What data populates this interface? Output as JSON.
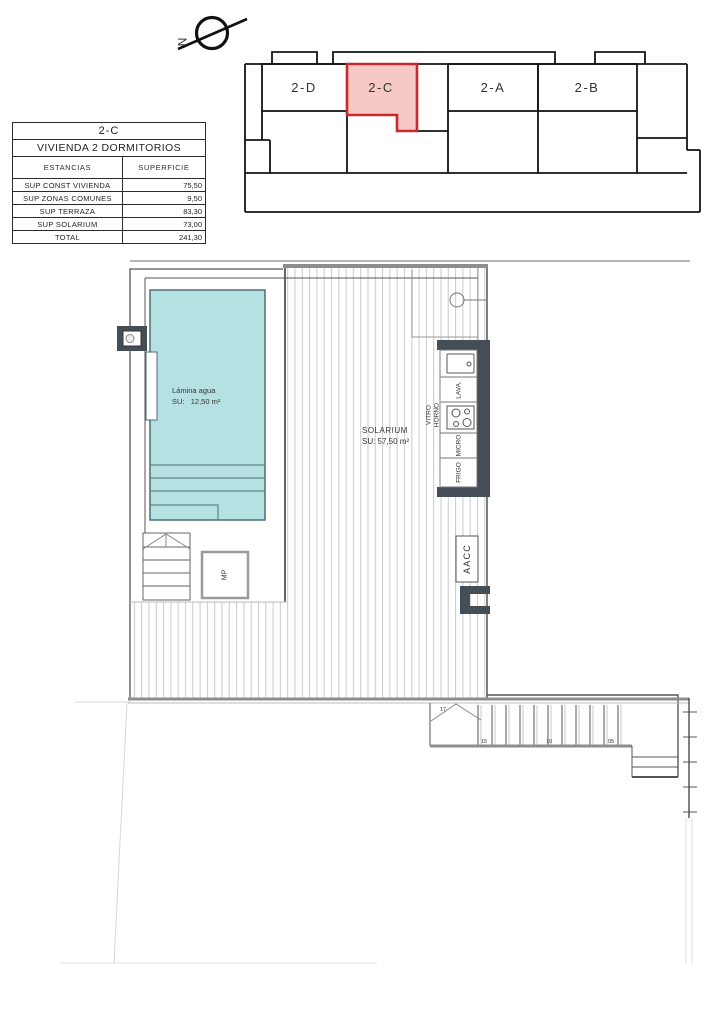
{
  "compass": {
    "label": "N"
  },
  "key_plan": {
    "units": [
      {
        "id": "2-D",
        "highlighted": false
      },
      {
        "id": "2-C",
        "highlighted": true
      },
      {
        "id": "2-A",
        "highlighted": false
      },
      {
        "id": "2-B",
        "highlighted": false
      }
    ],
    "highlight_fill": "#f6c9c6",
    "highlight_stroke": "#c9292e"
  },
  "area_table": {
    "title": "2-C",
    "subtitle": "VIVIENDA 2 DORMITORIOS",
    "col_headers": [
      "ESTANCIAS",
      "SUPERFICIE"
    ],
    "rows": [
      {
        "label": "SUP CONST VIVIENDA",
        "value": "75,50"
      },
      {
        "label": "SUP ZONAS COMUNES",
        "value": "9,50"
      },
      {
        "label": "SUP TERRAZA",
        "value": "83,30"
      },
      {
        "label": "SUP SOLARIUM",
        "value": "73,00"
      },
      {
        "label": "TOTAL",
        "value": "241,30"
      }
    ]
  },
  "floor_plan": {
    "pool": {
      "line1": "Lámina agua",
      "line2": "SU:   12,50 m²"
    },
    "solarium": {
      "line1": "SOLARIUM",
      "line2": "SU: 57,50 m²"
    },
    "kitchen": {
      "appliances": [
        "LAVA.",
        "MICRO",
        "FRIGO"
      ],
      "cooktop_line1": "VITRO",
      "cooktop_line2": "HORNO"
    },
    "aacc": "AACC",
    "mp": "MP",
    "stair_treads": [
      "17",
      "15",
      "10",
      "05"
    ],
    "colors": {
      "pool_fill": "#b5e1e3",
      "pool_stroke": "#4f6d72",
      "counter_dark": "#454e57",
      "aacc_text": "#8e2b8f",
      "hatch_line": "#cacaca"
    }
  }
}
